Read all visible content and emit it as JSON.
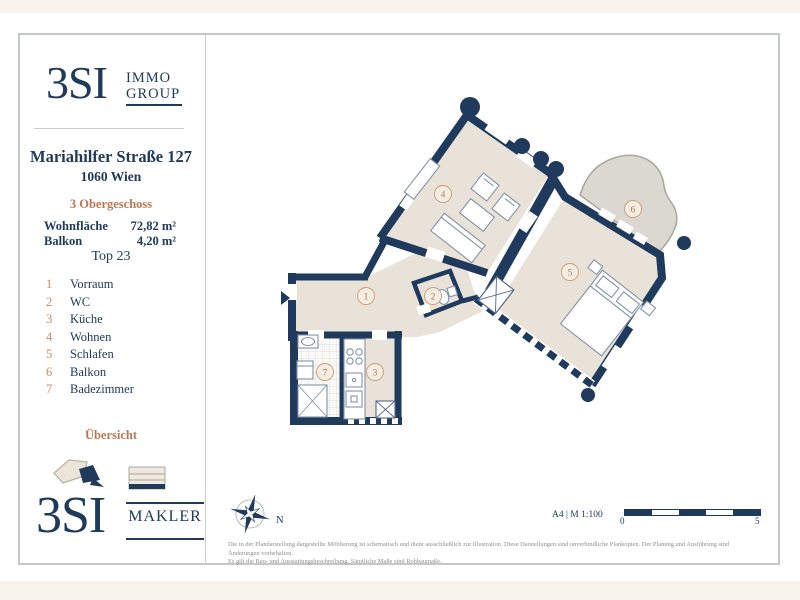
{
  "sidebar": {
    "brand_top": {
      "name": "3SI",
      "tagline1": "IMMO",
      "tagline2": "GROUP"
    },
    "address": {
      "line1": "Mariahilfer Straße 127",
      "line2": "1060 Wien"
    },
    "floor_label": "3 Obergeschoss",
    "areas": [
      {
        "label": "Wohnfläche",
        "value": "72,82 m²"
      },
      {
        "label": "Balkon",
        "value": "4,20 m²"
      }
    ],
    "unit_label": "Top 23",
    "rooms": [
      {
        "num": "1",
        "name": "Vorraum"
      },
      {
        "num": "2",
        "name": "WC"
      },
      {
        "num": "3",
        "name": "Küche"
      },
      {
        "num": "4",
        "name": "Wohnen"
      },
      {
        "num": "5",
        "name": "Schlafen"
      },
      {
        "num": "6",
        "name": "Balkon"
      },
      {
        "num": "7",
        "name": "Badezimmer"
      }
    ],
    "overview_label": "Übersicht",
    "brand_bottom": {
      "name": "3SI",
      "tagline": "MAKLER"
    }
  },
  "plan": {
    "compass_north": "N",
    "scale_label": "A4 | M 1:100",
    "scale_zero": "0",
    "scale_five": "5",
    "disclaimer_line1": "Die in der Plandarstellung dargestellte Möblierung ist schematisch und dient ausschließlich zur Illustration. Diese Darstellungen sind unverbindliche Plankopien. Der Planung und Ausführung sind Änderungen vorbehalten.",
    "disclaimer_line2": "Es gilt die Bau- und Ausstattungsbeschreibung. Sämtliche Maße sind Rohbaumaße."
  },
  "colors": {
    "navy": "#203a5c",
    "accent_orange": "#bf7650",
    "floor_beige": "#e9e2d8",
    "balcony_grey": "#dbd8d2",
    "cream": "#f7f3eb",
    "frame_grey": "#c5c8ca"
  }
}
